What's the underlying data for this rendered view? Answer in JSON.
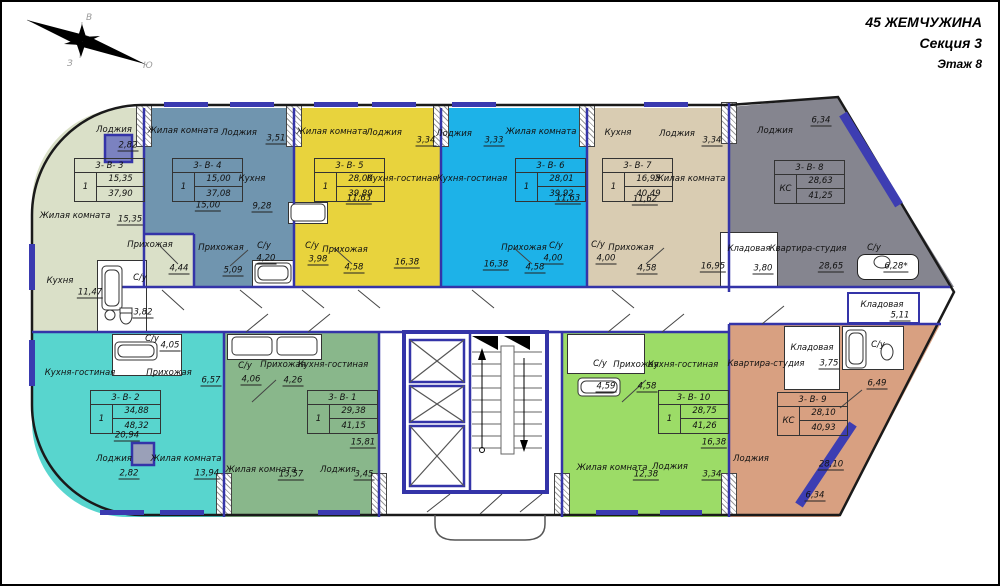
{
  "title_block": {
    "project": "45 ЖЕМЧУЖИНА",
    "section": "Секция 3",
    "floor": "Этаж 8"
  },
  "compass": {
    "east": "В",
    "west": "З",
    "south": "Ю"
  },
  "common": {
    "storage_name": "Кладовая",
    "storage_area": "5,11"
  },
  "apartments": [
    {
      "id": "3-В-3",
      "display_id": "3- В- 3",
      "type": "1",
      "living_area": "15,35",
      "total_area": "37,90",
      "color": "#dae0c8",
      "rooms": [
        {
          "name": "Лоджия",
          "area": "2,82"
        },
        {
          "name": "Жилая комната",
          "area": "15,35"
        },
        {
          "name": "Кухня",
          "area": "11,47"
        },
        {
          "name": "Прихожая",
          "area": "4,44"
        },
        {
          "name": "С/у",
          "area": "3,82"
        }
      ]
    },
    {
      "id": "3-В-4",
      "display_id": "3- В- 4",
      "type": "1",
      "living_area": "15,00",
      "total_area": "37,08",
      "color": "#7095af",
      "rooms": [
        {
          "name": "Жилая комната",
          "area": "15,00"
        },
        {
          "name": "Лоджия",
          "area": "3,51"
        },
        {
          "name": "Кухня",
          "area": "9,28"
        },
        {
          "name": "Прихожая",
          "area": "5,09"
        },
        {
          "name": "С/у",
          "area": "4,20"
        }
      ]
    },
    {
      "id": "3-В-5",
      "display_id": "3- В- 5",
      "type": "1",
      "living_area": "28,00",
      "total_area": "39,89",
      "color": "#e8d33d",
      "rooms": [
        {
          "name": "Жилая комната",
          "area": "11,63"
        },
        {
          "name": "Лоджия",
          "area": "3,34"
        },
        {
          "name": "Кухня-гостиная",
          "area": "16,38"
        },
        {
          "name": "Прихожая",
          "area": "4,58"
        },
        {
          "name": "С/у",
          "area": "3,98"
        }
      ]
    },
    {
      "id": "3-В-6",
      "display_id": "3- В- 6",
      "type": "1",
      "living_area": "28,01",
      "total_area": "39,92",
      "color": "#1db2e8",
      "rooms": [
        {
          "name": "Лоджия",
          "area": "3,33"
        },
        {
          "name": "Жилая комната",
          "area": "11,63"
        },
        {
          "name": "Кухня-гостиная",
          "area": "16,38"
        },
        {
          "name": "Прихожая",
          "area": "4,58"
        },
        {
          "name": "С/у",
          "area": "4,00"
        }
      ]
    },
    {
      "id": "3-В-7",
      "display_id": "3- В- 7",
      "type": "1",
      "living_area": "16,95",
      "total_area": "40,49",
      "color": "#d9ccb2",
      "rooms": [
        {
          "name": "Кухня",
          "area": "11,62"
        },
        {
          "name": "Лоджия",
          "area": "3,34"
        },
        {
          "name": "Жилая комната",
          "area": "16,95"
        },
        {
          "name": "Прихожая",
          "area": "4,58"
        },
        {
          "name": "С/у",
          "area": "4,00"
        }
      ]
    },
    {
      "id": "3-В-8",
      "display_id": "3- В- 8",
      "type": "КС",
      "living_area": "28,63",
      "total_area": "41,25",
      "color": "#85858f",
      "rooms": [
        {
          "name": "Лоджия",
          "area": "6,34"
        },
        {
          "name": "Квартира-студия",
          "area": "28,65"
        },
        {
          "name": "Кладовая",
          "area": "3,80"
        },
        {
          "name": "С/у",
          "area": "6,28*"
        }
      ]
    },
    {
      "id": "3-В-2",
      "display_id": "3- В- 2",
      "type": "1",
      "living_area": "34,88",
      "total_area": "48,32",
      "color": "#58d5ce",
      "rooms": [
        {
          "name": "С/у",
          "area": "4,05"
        },
        {
          "name": "Кухня-гостиная",
          "area": "20,94"
        },
        {
          "name": "Прихожая",
          "area": "6,57"
        },
        {
          "name": "Лоджия",
          "area": "2,82"
        },
        {
          "name": "Жилая комната",
          "area": "13,94"
        }
      ]
    },
    {
      "id": "3-В-1",
      "display_id": "3- В- 1",
      "type": "1",
      "living_area": "29,38",
      "total_area": "41,15",
      "color": "#89b78b",
      "rooms": [
        {
          "name": "С/у",
          "area": "4,06"
        },
        {
          "name": "Прихожая",
          "area": "4,26"
        },
        {
          "name": "Кухня-гостиная",
          "area": "15,81"
        },
        {
          "name": "Жилая комната",
          "area": "13,57"
        },
        {
          "name": "Лоджия",
          "area": "3,45"
        }
      ]
    },
    {
      "id": "3-В-10",
      "display_id": "3- В- 10",
      "type": "1",
      "living_area": "28,75",
      "total_area": "41,26",
      "color": "#9cdc67",
      "rooms": [
        {
          "name": "С/у",
          "area": "4,59"
        },
        {
          "name": "Прихожая",
          "area": "4,58"
        },
        {
          "name": "Кухня-гостиная",
          "area": "16,38"
        },
        {
          "name": "Жилая комната",
          "area": "12,38"
        },
        {
          "name": "Лоджия",
          "area": "3,34"
        }
      ]
    },
    {
      "id": "3-В-9",
      "display_id": "3- В- 9",
      "type": "КС",
      "living_area": "28,10",
      "total_area": "40,93",
      "color": "#d8a081",
      "rooms": [
        {
          "name": "Квартира-студия",
          "area": "28,10"
        },
        {
          "name": "Кладовая",
          "area": "3,75"
        },
        {
          "name": "С/у",
          "area": "6,49"
        },
        {
          "name": "Лоджия",
          "area": "6,34"
        }
      ]
    }
  ]
}
